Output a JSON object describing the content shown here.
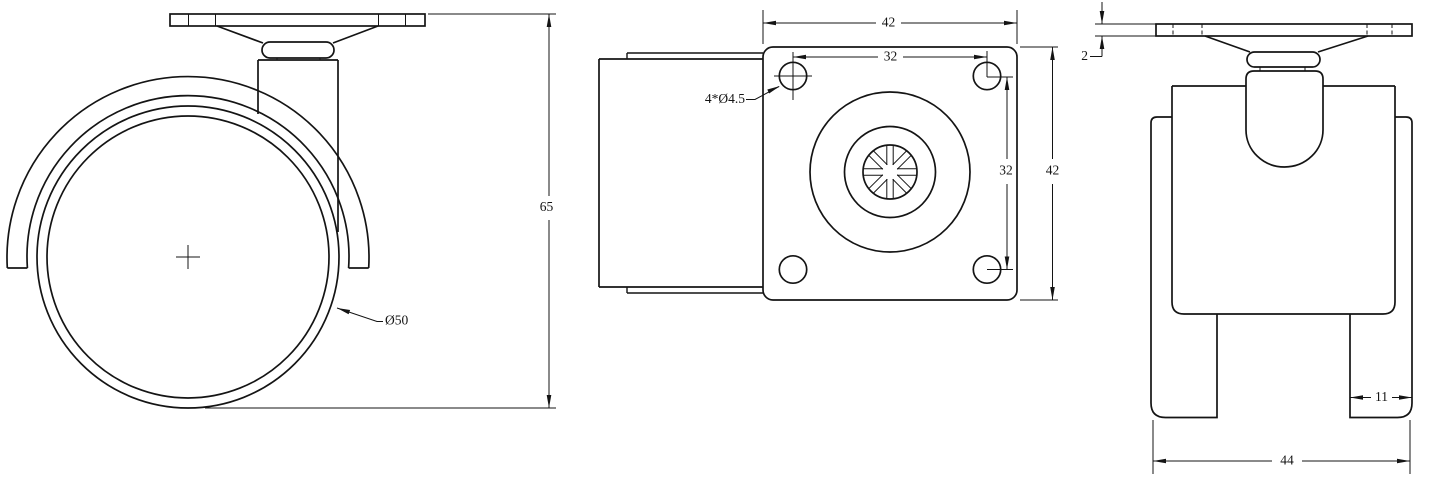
{
  "views": {
    "side": {
      "dimensions": {
        "overall_height": "65",
        "wheel_diameter": "Ø50"
      }
    },
    "top": {
      "dimensions": {
        "plate_width": "42",
        "hole_spacing_horizontal": "32",
        "hole_spacing_vertical": "32",
        "plate_depth": "42",
        "mounting_hole_callout": "4*Ø4.5"
      }
    },
    "front": {
      "dimensions": {
        "plate_thickness": "2",
        "wheel_width": "11",
        "overall_width": "44"
      }
    }
  },
  "colors": {
    "line": "#141414",
    "background": "#ffffff"
  }
}
